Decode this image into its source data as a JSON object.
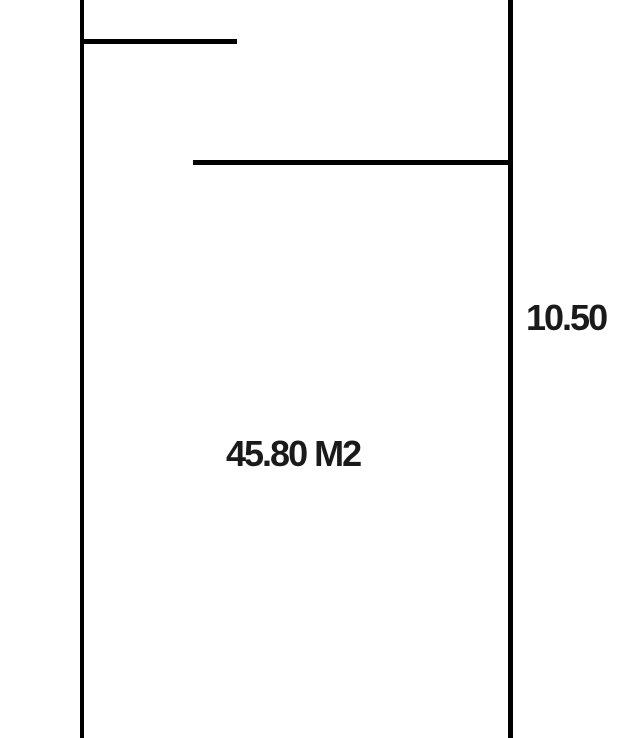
{
  "diagram": {
    "type": "floor-plan",
    "area_label": "45.80 M2",
    "dimension_right": "10.50"
  },
  "colors": {
    "wall": "#000000",
    "background": "#ffffff",
    "text": "#1a1a1a"
  }
}
